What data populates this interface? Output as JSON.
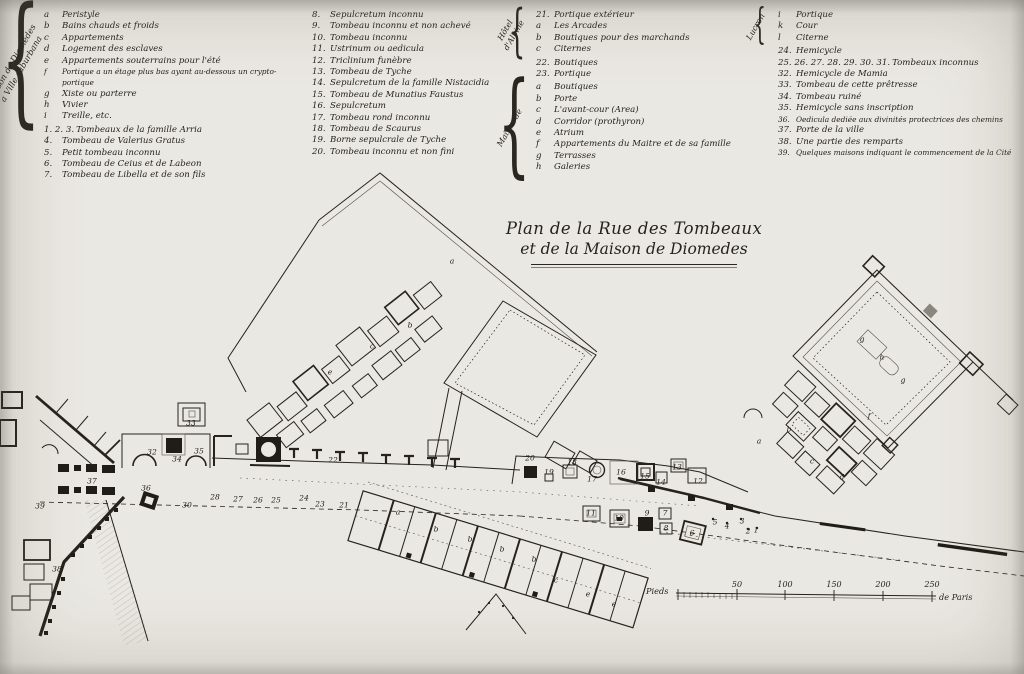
{
  "page": {
    "background": "#eae8e2",
    "ink": "#26231d"
  },
  "title": {
    "line1": "Plan de la Rue des Tombeaux",
    "line2": "et de la Maison de Diomedes"
  },
  "legend": {
    "columns": [
      {
        "x": 28,
        "width": 266,
        "groups": [
          {
            "brace": true,
            "label": "Maison de Diomedes\na Ville suburbana",
            "items": [
              {
                "n": "a",
                "t": "Peristyle"
              },
              {
                "n": "b",
                "t": "Bains chauds et froids"
              },
              {
                "n": "c",
                "t": "Appartements"
              },
              {
                "n": "d",
                "t": "Logement des esclaves"
              },
              {
                "n": "e",
                "t": "Appartements souterrains pour l'été"
              },
              {
                "n": "f",
                "t": "Portique a un étage plus bas ayant au-dessous un crypto-portique"
              },
              {
                "n": "g",
                "t": "Xiste ou parterre"
              },
              {
                "n": "h",
                "t": "Vivier"
              },
              {
                "n": "i",
                "t": "Treille, etc."
              }
            ]
          },
          {
            "brace": false,
            "label": "",
            "items": [
              {
                "n": "1. 2. 3.",
                "t": "Tombeaux de la famille Arria"
              },
              {
                "n": "4.",
                "t": "Tombeau de Valerius Gratus"
              },
              {
                "n": "5.",
                "t": "Petit tombeau inconnu"
              },
              {
                "n": "6.",
                "t": "Tombeau de Ceius et de Labeon"
              },
              {
                "n": "7.",
                "t": "Tombeau de Libella et de son fils"
              }
            ]
          }
        ]
      },
      {
        "x": 296,
        "width": 212,
        "groups": [
          {
            "brace": false,
            "label": "",
            "items": [
              {
                "n": "8.",
                "t": "Sepulcretum inconnu"
              },
              {
                "n": "9.",
                "t": "Tombeau inconnu et non achevé"
              },
              {
                "n": "10.",
                "t": "Tombeau inconnu"
              },
              {
                "n": "11.",
                "t": "Ustrinum ou aedicula"
              },
              {
                "n": "12.",
                "t": "Triclinium funèbre"
              },
              {
                "n": "13.",
                "t": "Tombeau de Tyche"
              },
              {
                "n": "14.",
                "t": "Sepulcretum de la famille Nistacidia"
              },
              {
                "n": "15.",
                "t": "Tombeau de Munatius Faustus"
              },
              {
                "n": "16.",
                "t": "Sepulcretum"
              },
              {
                "n": "17.",
                "t": "Tombeau rond inconnu"
              },
              {
                "n": "18.",
                "t": "Tombeau de Scaurus"
              },
              {
                "n": "19.",
                "t": "Borne sepulcrale de Tyche"
              },
              {
                "n": "20.",
                "t": "Tombeau inconnu et non fini"
              }
            ]
          }
        ]
      },
      {
        "x": 520,
        "width": 228,
        "groups": [
          {
            "brace": true,
            "label": "Hôtel\nd'Albine",
            "items": [
              {
                "n": "21.",
                "t": "Portique extérieur"
              },
              {
                "n": "a",
                "t": "Les Arcades"
              },
              {
                "n": "b",
                "t": "Boutiques pour des marchands"
              },
              {
                "n": "c",
                "t": "Citernes"
              }
            ]
          },
          {
            "brace": false,
            "label": "",
            "items": [
              {
                "n": "22.",
                "t": "Boutiques"
              },
              {
                "n": "23.",
                "t": "Portique"
              }
            ]
          },
          {
            "brace": true,
            "label": "Maison de",
            "items": [
              {
                "n": "a",
                "t": "Boutiques"
              },
              {
                "n": "b",
                "t": "Porte"
              },
              {
                "n": "c",
                "t": "L'avant-cour (Area)"
              },
              {
                "n": "d",
                "t": "Corridor (prothyron)"
              },
              {
                "n": "e",
                "t": "Atrium"
              },
              {
                "n": "f",
                "t": "Appartements du Maitre et de sa famille"
              },
              {
                "n": "g",
                "t": "Terrasses"
              },
              {
                "n": "h",
                "t": "Galeries"
              }
            ]
          }
        ]
      },
      {
        "x": 762,
        "width": 258,
        "groups": [
          {
            "brace": true,
            "label": "Lucron",
            "items": [
              {
                "n": "i",
                "t": "Portique"
              },
              {
                "n": "k",
                "t": "Cour"
              },
              {
                "n": "l",
                "t": "Citerne"
              }
            ]
          },
          {
            "brace": false,
            "label": "",
            "items": [
              {
                "n": "24.",
                "t": "Hemicycle"
              },
              {
                "n": "25. 26. 27. 28. 29. 30. 31.",
                "t": "Tombeaux inconnus"
              },
              {
                "n": "32.",
                "t": "Hemicycle de Mamia"
              },
              {
                "n": "33.",
                "t": "Tombeau de cette prêtresse"
              },
              {
                "n": "34.",
                "t": "Tombeau ruiné"
              },
              {
                "n": "35.",
                "t": "Hemicycle sans inscription"
              },
              {
                "n": "36.",
                "t": "Oedicula dediée aux divinités protectrices des chemins"
              },
              {
                "n": "37.",
                "t": "Porte de la ville"
              },
              {
                "n": "38.",
                "t": "Une partie des remparts"
              },
              {
                "n": "39.",
                "t": "Quelques maisons indiquant le commencement de la Cité"
              }
            ]
          }
        ]
      }
    ]
  },
  "scalebar": {
    "unit_left": "Pieds",
    "unit_right": "de Paris",
    "ticks": [
      "50",
      "100",
      "150",
      "200",
      "250"
    ]
  },
  "plan": {
    "labels": [
      {
        "t": "39",
        "x": 40,
        "y": 506
      },
      {
        "t": "38",
        "x": 57,
        "y": 569
      },
      {
        "t": "37",
        "x": 92,
        "y": 481
      },
      {
        "t": "36",
        "x": 146,
        "y": 488
      },
      {
        "t": "32",
        "x": 152,
        "y": 452
      },
      {
        "t": "34",
        "x": 177,
        "y": 459
      },
      {
        "t": "33",
        "x": 191,
        "y": 423
      },
      {
        "t": "35",
        "x": 199,
        "y": 451
      },
      {
        "t": "30",
        "x": 187,
        "y": 505
      },
      {
        "t": "28",
        "x": 215,
        "y": 497
      },
      {
        "t": "27",
        "x": 238,
        "y": 499
      },
      {
        "t": "26",
        "x": 258,
        "y": 500
      },
      {
        "t": "25",
        "x": 276,
        "y": 500
      },
      {
        "t": "24",
        "x": 304,
        "y": 498
      },
      {
        "t": "23",
        "x": 320,
        "y": 504
      },
      {
        "t": "22",
        "x": 333,
        "y": 460
      },
      {
        "t": "21",
        "x": 344,
        "y": 505
      },
      {
        "t": "20",
        "x": 530,
        "y": 458
      },
      {
        "t": "19",
        "x": 549,
        "y": 472
      },
      {
        "t": "18",
        "x": 572,
        "y": 462
      },
      {
        "t": "17",
        "x": 592,
        "y": 479
      },
      {
        "t": "16",
        "x": 621,
        "y": 472
      },
      {
        "t": "15",
        "x": 645,
        "y": 476
      },
      {
        "t": "14",
        "x": 661,
        "y": 482
      },
      {
        "t": "13",
        "x": 677,
        "y": 467
      },
      {
        "t": "12",
        "x": 698,
        "y": 481
      },
      {
        "t": "11",
        "x": 591,
        "y": 513
      },
      {
        "t": "10",
        "x": 619,
        "y": 518
      },
      {
        "t": "9",
        "x": 647,
        "y": 513
      },
      {
        "t": "7",
        "x": 665,
        "y": 513
      },
      {
        "t": "8",
        "x": 666,
        "y": 528
      },
      {
        "t": "6",
        "x": 692,
        "y": 533
      },
      {
        "t": "5",
        "x": 715,
        "y": 522
      },
      {
        "t": "4",
        "x": 727,
        "y": 526
      },
      {
        "t": "3",
        "x": 742,
        "y": 521
      },
      {
        "t": "2",
        "x": 748,
        "y": 531
      },
      {
        "t": "1",
        "x": 756,
        "y": 530
      },
      {
        "t": "a",
        "x": 452,
        "y": 261
      },
      {
        "t": "b",
        "x": 410,
        "y": 325
      },
      {
        "t": "c",
        "x": 372,
        "y": 346
      },
      {
        "t": "e",
        "x": 330,
        "y": 372
      },
      {
        "t": "g",
        "x": 862,
        "y": 339
      },
      {
        "t": "h",
        "x": 882,
        "y": 357
      },
      {
        "t": "g",
        "x": 903,
        "y": 380
      },
      {
        "t": "f",
        "x": 869,
        "y": 416
      },
      {
        "t": "a",
        "x": 759,
        "y": 441
      },
      {
        "t": "b",
        "x": 789,
        "y": 429
      },
      {
        "t": "c",
        "x": 812,
        "y": 461
      },
      {
        "t": "d",
        "x": 842,
        "y": 477
      },
      {
        "t": "a",
        "x": 398,
        "y": 512
      },
      {
        "t": "b",
        "x": 436,
        "y": 529
      },
      {
        "t": "b",
        "x": 470,
        "y": 539
      },
      {
        "t": "b",
        "x": 502,
        "y": 549
      },
      {
        "t": "b",
        "x": 534,
        "y": 559
      },
      {
        "t": "c",
        "x": 556,
        "y": 580
      },
      {
        "t": "e",
        "x": 588,
        "y": 594
      },
      {
        "t": "e",
        "x": 614,
        "y": 604
      }
    ]
  }
}
